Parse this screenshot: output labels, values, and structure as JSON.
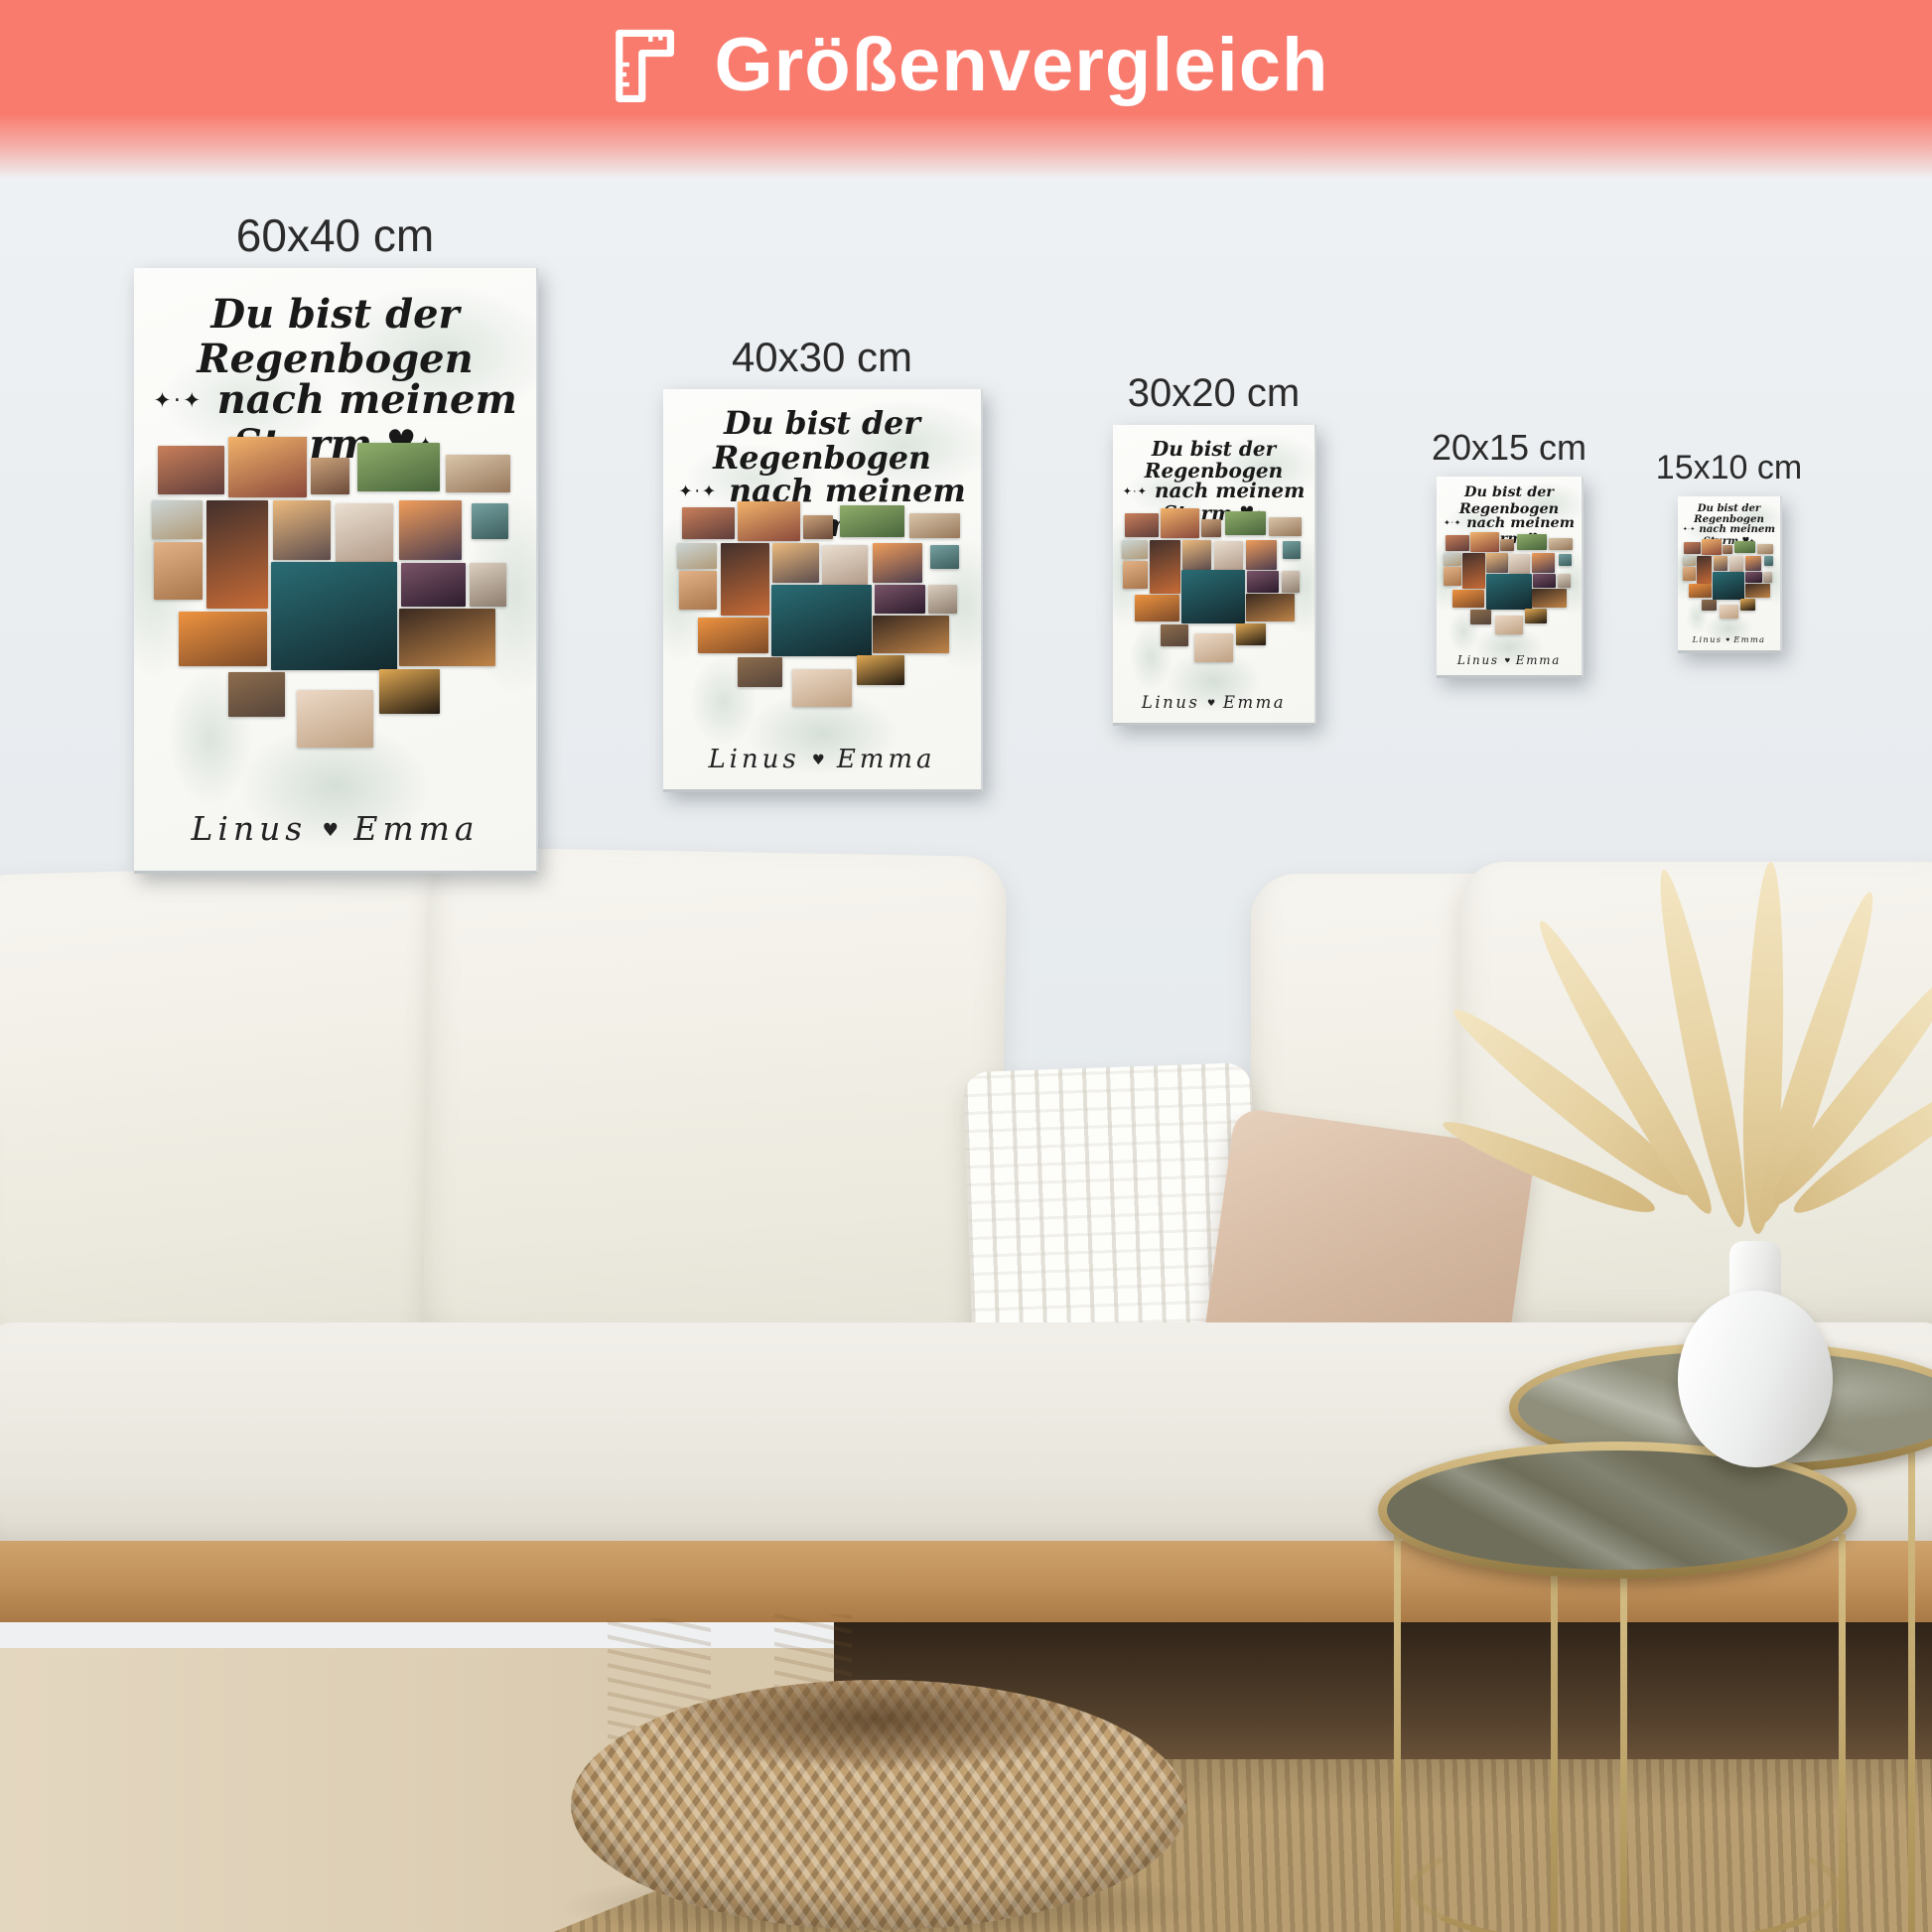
{
  "banner": {
    "title": "Größenvergleich",
    "icon": "ruler-icon",
    "bg_color": "#f97b6e",
    "text_color": "#ffffff"
  },
  "posters": [
    {
      "id": "60x40",
      "label": "60x40 cm"
    },
    {
      "id": "40x30",
      "label": "40x30 cm"
    },
    {
      "id": "30x20",
      "label": "30x20 cm"
    },
    {
      "id": "20x15",
      "label": "20x15 cm"
    },
    {
      "id": "15x10",
      "label": "15x10 cm"
    }
  ],
  "poster_design": {
    "title_line1": "Du bist der Regenbogen",
    "title_line2": "nach meinem Sturm",
    "decor_left": "✦·✦",
    "decor_right": "✦",
    "heart": "♥",
    "names": {
      "left": "Linus",
      "heart": "♥",
      "right": "Emma"
    },
    "collage_tiles": [
      {
        "name": "beach-party",
        "x": 6,
        "y": 29.5,
        "w": 16.5,
        "h": 8,
        "c1": "#c97f5a",
        "c2": "#5f3d3a"
      },
      {
        "name": "palm-sunset-dancers",
        "x": 23.5,
        "y": 28,
        "w": 19.5,
        "h": 10,
        "c1": "#f2b26a",
        "c2": "#8a4a3c"
      },
      {
        "name": "couple-snack",
        "x": 44,
        "y": 31.5,
        "w": 9.5,
        "h": 6,
        "c1": "#caa27a",
        "c2": "#6b4a3a"
      },
      {
        "name": "garden-dinner",
        "x": 55.5,
        "y": 29,
        "w": 20.5,
        "h": 8,
        "c1": "#8fae6a",
        "c2": "#49653c"
      },
      {
        "name": "beach-friends",
        "x": 77.5,
        "y": 31,
        "w": 16,
        "h": 6.2,
        "c1": "#d9c5a9",
        "c2": "#97785c"
      },
      {
        "name": "family-shore",
        "x": 4.5,
        "y": 38.5,
        "w": 12.5,
        "h": 6.5,
        "c1": "#ccd6d6",
        "c2": "#b09a78"
      },
      {
        "name": "beach-walk",
        "x": 5,
        "y": 45.5,
        "w": 12,
        "h": 9.5,
        "c1": "#e2b286",
        "c2": "#a9764c"
      },
      {
        "name": "campfire",
        "x": 18,
        "y": 38.5,
        "w": 15.3,
        "h": 18,
        "c1": "#42302c",
        "c2": "#c76b36"
      },
      {
        "name": "palm-beach-sunset",
        "x": 34.5,
        "y": 38.5,
        "w": 14.5,
        "h": 10,
        "c1": "#ecba7e",
        "c2": "#5c4c4c"
      },
      {
        "name": "friends-in-white",
        "x": 50,
        "y": 39,
        "w": 14.5,
        "h": 10,
        "c1": "#eadfd1",
        "c2": "#b29a88"
      },
      {
        "name": "ocean-sunset",
        "x": 66,
        "y": 38.5,
        "w": 15.5,
        "h": 10,
        "c1": "#ef9d5b",
        "c2": "#4c3c4e"
      },
      {
        "name": "silhouette-group",
        "x": 66.5,
        "y": 49,
        "w": 16,
        "h": 7.2,
        "c1": "#7a5468",
        "c2": "#2c1c2c"
      },
      {
        "name": "beach-couple",
        "x": 83.5,
        "y": 49,
        "w": 9,
        "h": 7.2,
        "c1": "#dccfc0",
        "c2": "#8d7d6e"
      },
      {
        "name": "hilltop-friends",
        "x": 84,
        "y": 39,
        "w": 9,
        "h": 6,
        "c1": "#75a0a0",
        "c2": "#3d5d5d"
      },
      {
        "name": "night-party-lights",
        "x": 34,
        "y": 48.8,
        "w": 31.5,
        "h": 18,
        "c1": "#2a6c74",
        "c2": "#13292e"
      },
      {
        "name": "sunset-toast",
        "x": 11,
        "y": 57,
        "w": 22,
        "h": 9,
        "c1": "#ee9340",
        "c2": "#7c4a28"
      },
      {
        "name": "candlelight-dinner",
        "x": 66,
        "y": 56.5,
        "w": 24,
        "h": 9.6,
        "c1": "#3a2a20",
        "c2": "#c08448"
      },
      {
        "name": "table-gathering",
        "x": 23.5,
        "y": 67,
        "w": 14,
        "h": 7.4,
        "c1": "#8d6d4d",
        "c2": "#55443a"
      },
      {
        "name": "family-beach",
        "x": 40.5,
        "y": 70,
        "w": 19,
        "h": 9.5,
        "c1": "#ecd9c6",
        "c2": "#bfa183"
      },
      {
        "name": "sparklers",
        "x": 61,
        "y": 66.6,
        "w": 15,
        "h": 7.4,
        "c1": "#e0a853",
        "c2": "#221a12"
      }
    ]
  },
  "palette": {
    "banner": "#f97b6e",
    "wall": "#e8edf0",
    "wood": "#c49a66",
    "brass": "#c9b078",
    "pouf": "#c2a173",
    "rug": "#b99e71"
  }
}
